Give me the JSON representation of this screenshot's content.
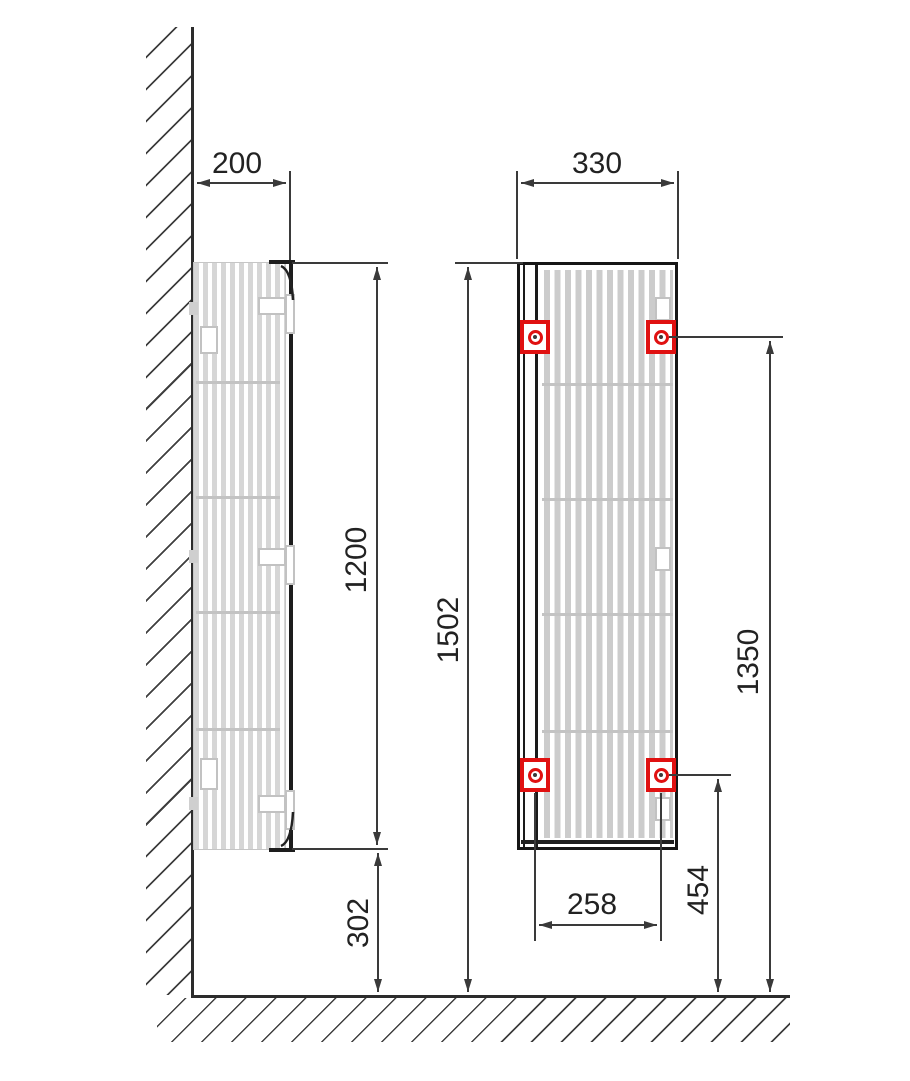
{
  "title": "Wall-mounted cabinet installation drawing",
  "views": {
    "side": {
      "label_depth": "200",
      "label_height": "1200",
      "label_floor_gap": "302"
    },
    "front": {
      "label_width": "330",
      "label_total_height": "1502",
      "label_upper_mount": "1350",
      "label_lower_mount": "454",
      "label_mount_spacing": "258"
    }
  },
  "colors": {
    "mount_red": "#e01111",
    "dimension_line": "#3a3a3a",
    "slat_gray": "#d6d6d6",
    "outline_black": "#161616"
  }
}
